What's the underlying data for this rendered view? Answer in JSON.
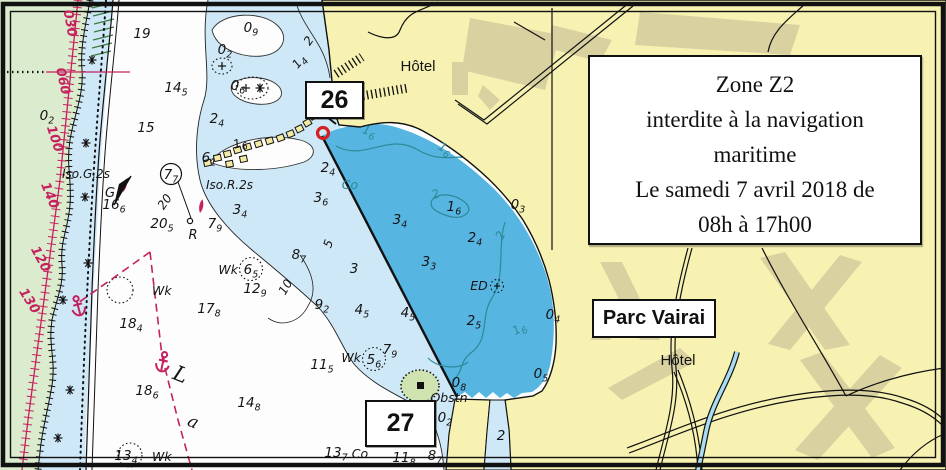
{
  "map": {
    "colors": {
      "land": "#f7f2b2",
      "land-patch": "#d9d1a0",
      "reef-green": "#daeccd",
      "shallow": "#cfe8f7",
      "zone": "#57b5e2",
      "magenta": "#c6215f",
      "teal": "#2e8a96",
      "islet-green": "#cfe3b0"
    },
    "notice_box": {
      "lines": [
        "Zone Z2",
        "interdite à la navigation",
        "maritime",
        "Le samedi 7 avril 2018 de",
        "08h à 17h00"
      ]
    },
    "labels": {
      "marker_26": "26",
      "marker_27": "27",
      "parc": "Parc Vairai",
      "hotel_top": "Hôtel",
      "hotel_bottom": "Hôtel"
    },
    "soundings": [
      {
        "x": 142,
        "y": 38,
        "t": "19"
      },
      {
        "x": 176,
        "y": 92,
        "t": "14",
        "s": "5"
      },
      {
        "x": 146,
        "y": 132,
        "t": "15"
      },
      {
        "x": 114,
        "y": 209,
        "t": "16",
        "s": "6"
      },
      {
        "x": 162,
        "y": 228,
        "t": "20",
        "s": "5"
      },
      {
        "x": 209,
        "y": 313,
        "t": "17",
        "s": "8"
      },
      {
        "x": 131,
        "y": 328,
        "t": "18",
        "s": "4"
      },
      {
        "x": 147,
        "y": 395,
        "t": "18",
        "s": "6"
      },
      {
        "x": 249,
        "y": 407,
        "t": "14",
        "s": "8"
      },
      {
        "x": 126,
        "y": 460,
        "t": "13",
        "s": "4"
      },
      {
        "x": 322,
        "y": 369,
        "t": "11",
        "s": "5"
      },
      {
        "x": 299,
        "y": 259,
        "t": "8",
        "s": "7"
      },
      {
        "x": 255,
        "y": 293,
        "t": "12",
        "s": "9"
      },
      {
        "x": 322,
        "y": 309,
        "t": "9",
        "s": "2"
      },
      {
        "x": 251,
        "y": 32,
        "t": "0",
        "s": "9"
      },
      {
        "x": 225,
        "y": 54,
        "t": "0",
        "s": "2"
      },
      {
        "x": 238,
        "y": 90,
        "t": "0",
        "s": "6"
      },
      {
        "x": 217,
        "y": 123,
        "t": "2",
        "s": "4"
      },
      {
        "x": 209,
        "y": 162,
        "t": "6",
        "s": "1"
      },
      {
        "x": 240,
        "y": 214,
        "t": "3",
        "s": "4"
      },
      {
        "x": 215,
        "y": 228,
        "t": "7",
        "s": "9"
      },
      {
        "x": 328,
        "y": 172,
        "t": "2",
        "s": "4"
      },
      {
        "x": 321,
        "y": 202,
        "t": "3",
        "s": "6"
      },
      {
        "x": 354,
        "y": 273,
        "t": "3"
      },
      {
        "x": 362,
        "y": 314,
        "t": "4",
        "s": "5"
      },
      {
        "x": 408,
        "y": 317,
        "t": "4",
        "s": "5"
      },
      {
        "x": 435,
        "y": 460,
        "t": "8",
        "s": "7"
      },
      {
        "x": 404,
        "y": 462,
        "t": "11",
        "s": "8"
      },
      {
        "x": 336,
        "y": 457,
        "t": "13",
        "s": "7"
      },
      {
        "x": 47,
        "y": 120,
        "t": "0",
        "s": "2"
      },
      {
        "x": 400,
        "y": 224,
        "t": "3",
        "s": "4"
      },
      {
        "x": 518,
        "y": 209,
        "t": "0",
        "s": "3"
      },
      {
        "x": 475,
        "y": 242,
        "t": "2",
        "s": "4"
      },
      {
        "x": 429,
        "y": 266,
        "t": "3",
        "s": "3"
      },
      {
        "x": 474,
        "y": 325,
        "t": "2",
        "s": "5"
      },
      {
        "x": 553,
        "y": 319,
        "t": "0",
        "s": "4"
      },
      {
        "x": 541,
        "y": 378,
        "t": "0",
        "s": "5"
      },
      {
        "x": 459,
        "y": 387,
        "t": "0",
        "s": "8"
      },
      {
        "x": 445,
        "y": 422,
        "t": "0",
        "s": "2"
      },
      {
        "x": 501,
        "y": 440,
        "t": "2"
      },
      {
        "x": 454,
        "y": 211,
        "t": "1",
        "s": "6"
      },
      {
        "x": 171,
        "y": 179,
        "t": "7",
        "s": "7"
      },
      {
        "x": 251,
        "y": 274,
        "t": "6",
        "s": "5"
      },
      {
        "x": 374,
        "y": 364,
        "t": "5",
        "s": "6"
      },
      {
        "x": 390,
        "y": 354,
        "t": "7",
        "s": "9"
      }
    ],
    "contour_labels": [
      {
        "x": 368,
        "y": 135,
        "t": "1",
        "s": "6",
        "rot": 18,
        "cls": "teal"
      },
      {
        "x": 443,
        "y": 152,
        "t": "1",
        "s": "6",
        "rot": 30,
        "cls": "teal"
      },
      {
        "x": 437,
        "y": 198,
        "t": "2",
        "rot": -20,
        "cls": "teal"
      },
      {
        "x": 504,
        "y": 237,
        "t": "2",
        "rot": -65,
        "cls": "teal"
      },
      {
        "x": 521,
        "y": 332,
        "t": "1",
        "s": "6",
        "rot": -30,
        "cls": "teal"
      },
      {
        "x": 332,
        "y": 245,
        "t": "5",
        "rot": -70
      },
      {
        "x": 289,
        "y": 289,
        "t": "10",
        "rot": -60
      },
      {
        "x": 241,
        "y": 147,
        "t": "1",
        "s": "6",
        "rot": -15
      },
      {
        "x": 312,
        "y": 43,
        "t": "2",
        "rot": -55
      },
      {
        "x": 302,
        "y": 64,
        "t": "1",
        "s": "4",
        "rot": -50
      },
      {
        "x": 168,
        "y": 204,
        "t": "20",
        "rot": -55
      }
    ],
    "bearing_numbers": [
      {
        "x": 66,
        "y": 24,
        "t": "030",
        "rot": 80
      },
      {
        "x": 59,
        "y": 82,
        "t": "060",
        "rot": 78
      },
      {
        "x": 51,
        "y": 140,
        "t": "100",
        "rot": 72
      },
      {
        "x": 46,
        "y": 197,
        "t": "140",
        "rot": 68
      },
      {
        "x": 37,
        "y": 261,
        "t": "120",
        "rot": 62
      },
      {
        "x": 26,
        "y": 303,
        "t": "130",
        "rot": 58
      }
    ],
    "feature_texts": [
      {
        "t": "Iso.G.2s",
        "x": 62,
        "y": 178,
        "cls": "lt",
        "anchor": "start"
      },
      {
        "t": "G",
        "x": 110,
        "y": 197,
        "cls": "lt2"
      },
      {
        "t": "Iso.R.2s",
        "x": 206,
        "y": 189,
        "cls": "lt",
        "anchor": "start"
      },
      {
        "t": "R",
        "x": 193,
        "y": 239,
        "cls": "lt2"
      },
      {
        "t": "Wk",
        "x": 152,
        "y": 295,
        "cls": "wk",
        "anchor": "start"
      },
      {
        "t": "Wk",
        "x": 152,
        "y": 461,
        "cls": "wk",
        "anchor": "start"
      },
      {
        "t": "Wk",
        "x": 238,
        "y": 274,
        "cls": "wk",
        "anchor": "end"
      },
      {
        "t": "Wk",
        "x": 361,
        "y": 362,
        "cls": "wk",
        "anchor": "end"
      },
      {
        "t": "ED",
        "x": 479,
        "y": 290,
        "cls": "ed"
      },
      {
        "t": "Obstn",
        "x": 449,
        "y": 402,
        "cls": "ed"
      },
      {
        "t": "Co",
        "x": 350,
        "y": 189,
        "cls": "co"
      },
      {
        "t": "Co",
        "x": 360,
        "y": 458,
        "cls": "ed"
      },
      {
        "t": "L",
        "x": 178,
        "y": 381,
        "cls": "lag",
        "rot": 22
      },
      {
        "t": "a",
        "x": 191,
        "y": 427,
        "cls": "lag2",
        "rot": 24
      }
    ]
  }
}
